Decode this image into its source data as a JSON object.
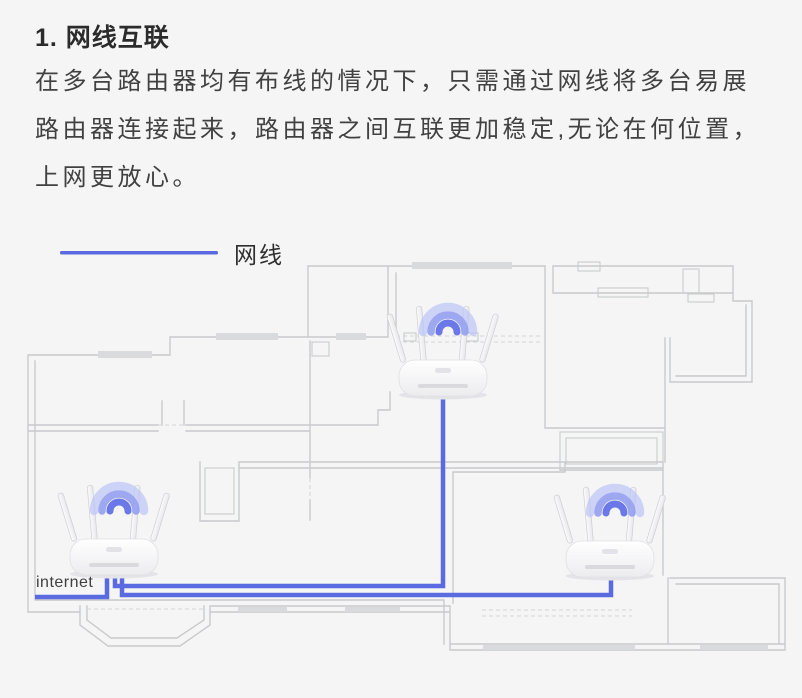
{
  "heading": {
    "title": "1. 网线互联"
  },
  "paragraph": {
    "lines": [
      "在多台路由器均有布线的情况下，只需通过网线将多台易展",
      "路由器连接起来，路由器之间互联更加稳定,无论在何位置，",
      "上网更放心。"
    ]
  },
  "legend": {
    "label": "网线",
    "line_color": "#5c6ae2"
  },
  "diagram": {
    "internet_label": "internet",
    "router_count": 3,
    "cable_color": "#5c6ae2",
    "wall_color": "#c9cacc",
    "window_color": "#d9dadb",
    "opening_color": "#d4d5d7",
    "wifi_color": "#6b79e8",
    "background": "#f5f5f6"
  }
}
